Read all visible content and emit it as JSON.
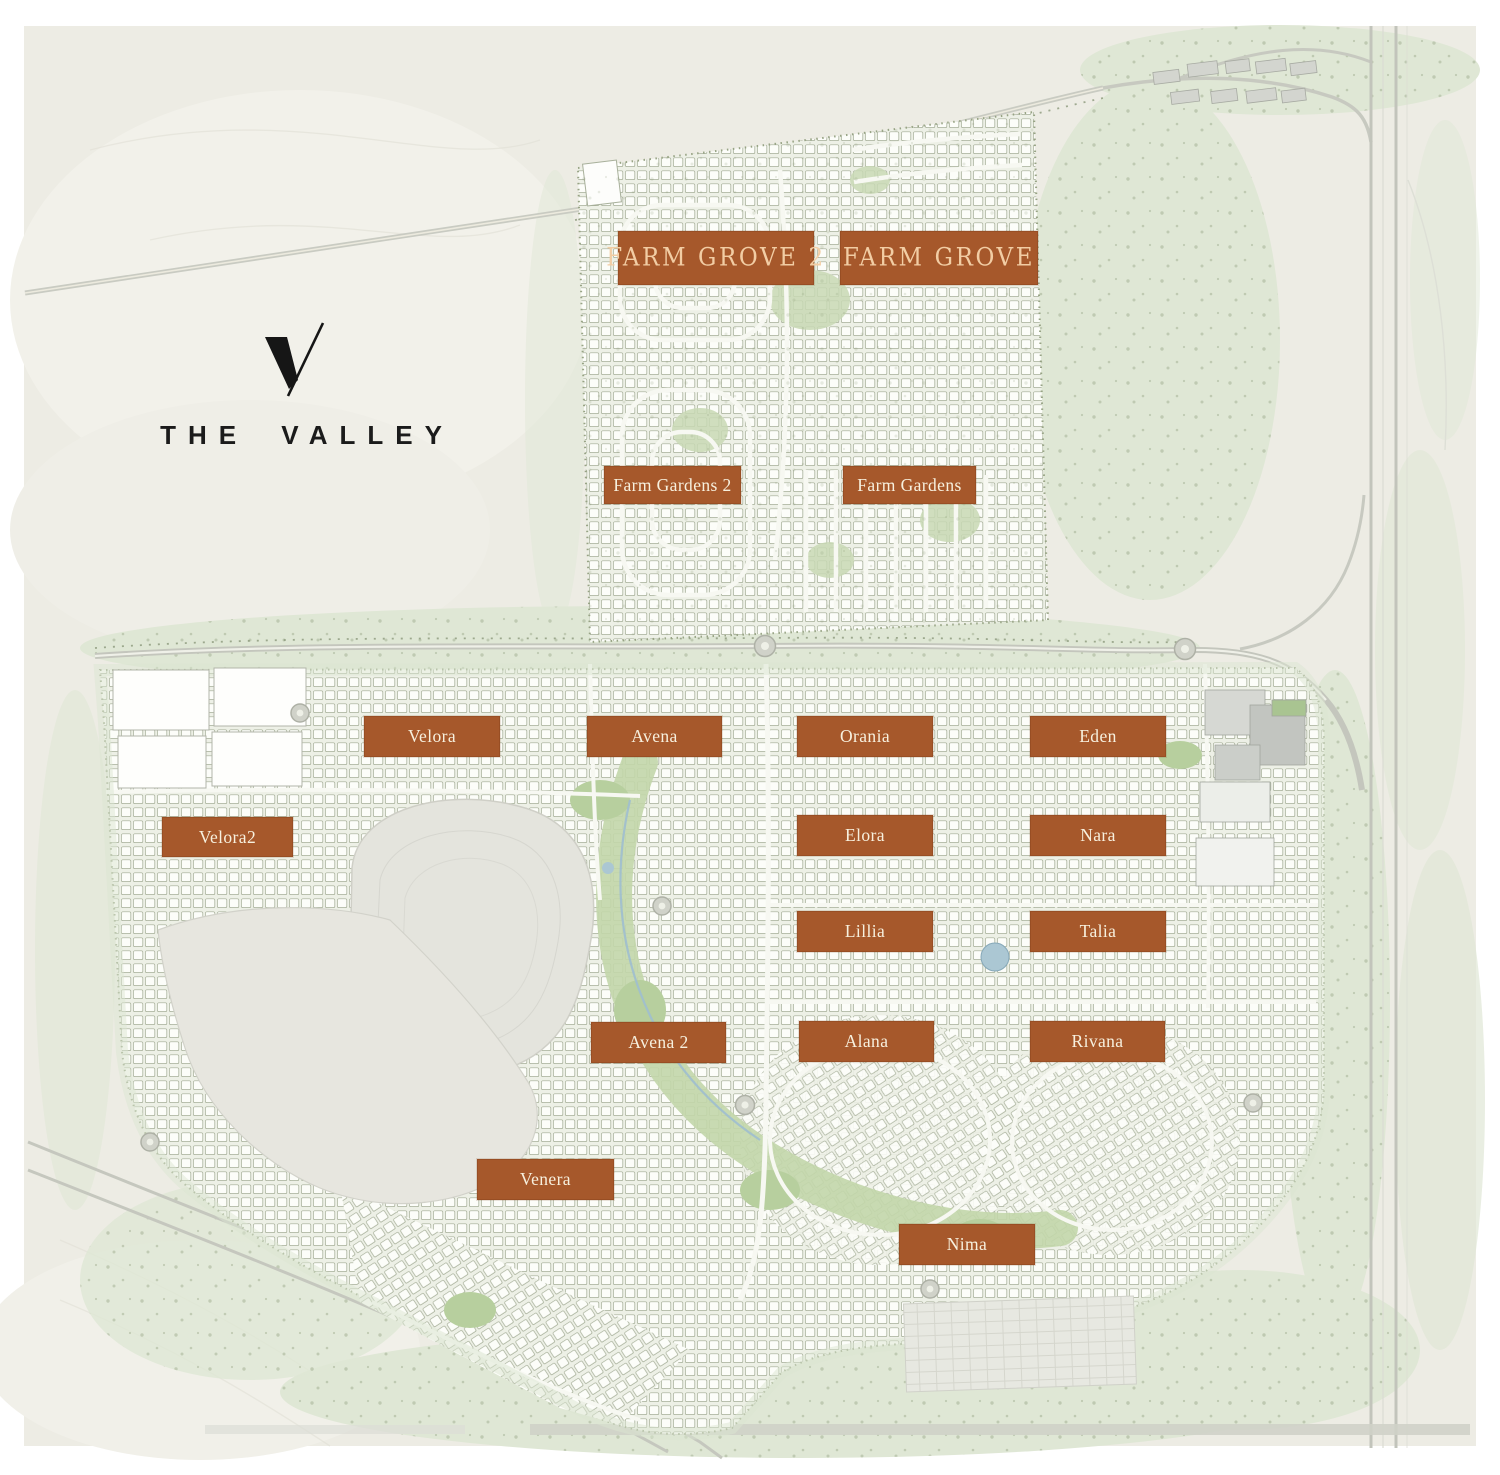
{
  "brand": {
    "name": "THE VALLEY",
    "logo_icon": "v-slash-monogram"
  },
  "colors": {
    "frame": "#ffffff",
    "map_base": "#edece4",
    "label_bg": "#a6582b",
    "label_text": "#f7f0de",
    "display_label_text": "#f2cda4",
    "logo_text": "#1b1b1b",
    "sage_green": "#dfe7d5",
    "road_gray": "#c5c7be",
    "housing_white": "#fcfdf9"
  },
  "map": {
    "type": "master-plan",
    "districts": [
      {
        "id": "farm-grove-2",
        "label": "FARM GROVE 2",
        "variant": "display",
        "x": 618,
        "y": 231,
        "w": 196,
        "h": 54
      },
      {
        "id": "farm-grove",
        "label": "FARM GROVE",
        "variant": "display",
        "x": 840,
        "y": 231,
        "w": 198,
        "h": 54
      },
      {
        "id": "farm-gardens-2",
        "label": "Farm Gardens 2",
        "variant": "standard",
        "x": 604,
        "y": 466,
        "w": 137,
        "h": 38
      },
      {
        "id": "farm-gardens",
        "label": "Farm Gardens",
        "variant": "standard",
        "x": 843,
        "y": 466,
        "w": 133,
        "h": 38
      },
      {
        "id": "velora",
        "label": "Velora",
        "variant": "standard",
        "x": 364,
        "y": 716,
        "w": 136,
        "h": 41
      },
      {
        "id": "avena",
        "label": "Avena",
        "variant": "standard",
        "x": 587,
        "y": 716,
        "w": 135,
        "h": 41
      },
      {
        "id": "orania",
        "label": "Orania",
        "variant": "standard",
        "x": 797,
        "y": 716,
        "w": 136,
        "h": 41
      },
      {
        "id": "eden",
        "label": "Eden",
        "variant": "standard",
        "x": 1030,
        "y": 716,
        "w": 136,
        "h": 41
      },
      {
        "id": "velora2",
        "label": "Velora2",
        "variant": "standard",
        "x": 162,
        "y": 817,
        "w": 131,
        "h": 40
      },
      {
        "id": "elora",
        "label": "Elora",
        "variant": "standard",
        "x": 797,
        "y": 815,
        "w": 136,
        "h": 41
      },
      {
        "id": "nara",
        "label": "Nara",
        "variant": "standard",
        "x": 1030,
        "y": 815,
        "w": 136,
        "h": 41
      },
      {
        "id": "lillia",
        "label": "Lillia",
        "variant": "standard",
        "x": 797,
        "y": 911,
        "w": 136,
        "h": 41
      },
      {
        "id": "talia",
        "label": "Talia",
        "variant": "standard",
        "x": 1030,
        "y": 911,
        "w": 136,
        "h": 41
      },
      {
        "id": "avena-2",
        "label": "Avena 2",
        "variant": "standard",
        "x": 591,
        "y": 1022,
        "w": 135,
        "h": 41
      },
      {
        "id": "alana",
        "label": "Alana",
        "variant": "standard",
        "x": 799,
        "y": 1021,
        "w": 135,
        "h": 41
      },
      {
        "id": "rivana",
        "label": "Rivana",
        "variant": "standard",
        "x": 1030,
        "y": 1021,
        "w": 135,
        "h": 41
      },
      {
        "id": "venera",
        "label": "Venera",
        "variant": "standard",
        "x": 477,
        "y": 1159,
        "w": 137,
        "h": 41
      },
      {
        "id": "nima",
        "label": "Nima",
        "variant": "standard",
        "x": 899,
        "y": 1224,
        "w": 136,
        "h": 41
      }
    ]
  }
}
